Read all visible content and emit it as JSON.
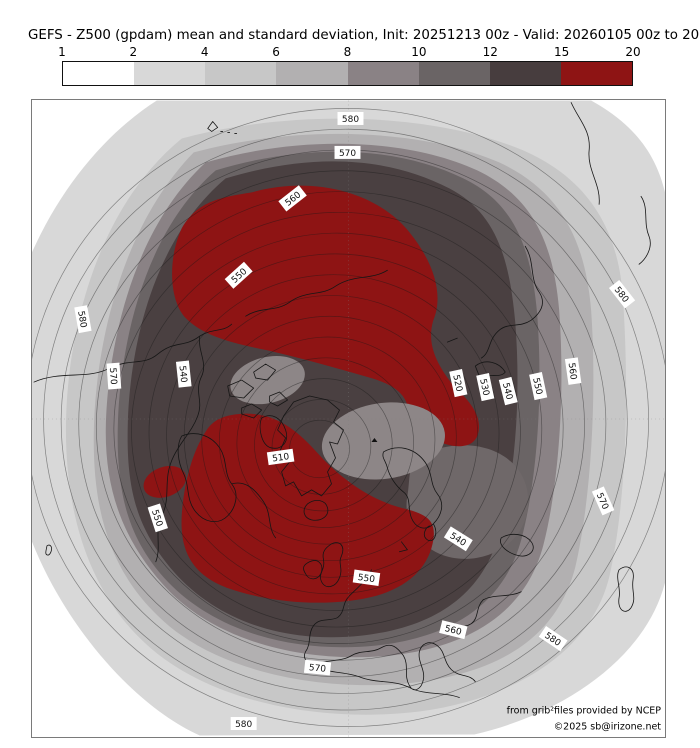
{
  "title": "GEFS - Z500 (gpdam) mean and standard deviation, Init: 20251213 00z - Valid: 20260105 00z to 20260112 00z",
  "colorbar": {
    "ticks": [
      "1",
      "2",
      "4",
      "6",
      "8",
      "10",
      "12",
      "15",
      "20"
    ],
    "segments": [
      {
        "range": "1-2",
        "color": "#ffffff"
      },
      {
        "range": "2-4",
        "color": "#d8d8d8"
      },
      {
        "range": "4-6",
        "color": "#c7c7c7"
      },
      {
        "range": "6-8",
        "color": "#b2b0b1"
      },
      {
        "range": "8-10",
        "color": "#8a8285"
      },
      {
        "range": "10-12",
        "color": "#6a6465"
      },
      {
        "range": "12-15",
        "color": "#473d3e"
      },
      {
        "range": "15-20",
        "color": "#8e1414"
      }
    ]
  },
  "palette": {
    "sd_1_2": "#ffffff",
    "sd_2_4": "#d8d8d8",
    "sd_4_6": "#c7c7c7",
    "sd_6_8": "#b2b0b1",
    "sd_8_10": "#8a8285",
    "sd_10_12": "#6a6465",
    "sd_12_15": "#473d3e",
    "sd_15_20": "#8e1414",
    "map_core": "#4a4041",
    "map_patch": "#8d8687",
    "map_se_patch": "#6f6869"
  },
  "map": {
    "attribution_line1": "from grib²files provided by NCEP",
    "attribution_line2": "©2025 sb@irizone.net",
    "contour_labels": [
      {
        "v": "580",
        "x": 319,
        "y": 18,
        "r": 0
      },
      {
        "v": "570",
        "x": 316,
        "y": 52,
        "r": 0
      },
      {
        "v": "560",
        "x": 261,
        "y": 98,
        "r": -38
      },
      {
        "v": "550",
        "x": 207,
        "y": 175,
        "r": -42
      },
      {
        "v": "580",
        "x": 51,
        "y": 219,
        "r": 80
      },
      {
        "v": "570",
        "x": 82,
        "y": 276,
        "r": 86
      },
      {
        "v": "540",
        "x": 152,
        "y": 274,
        "r": 84
      },
      {
        "v": "550",
        "x": 126,
        "y": 418,
        "r": 72
      },
      {
        "v": "510",
        "x": 249,
        "y": 357,
        "r": -8
      },
      {
        "v": "520",
        "x": 427,
        "y": 283,
        "r": 78
      },
      {
        "v": "530",
        "x": 454,
        "y": 287,
        "r": 78
      },
      {
        "v": "540",
        "x": 477,
        "y": 291,
        "r": 76
      },
      {
        "v": "550",
        "x": 507,
        "y": 286,
        "r": 78
      },
      {
        "v": "560",
        "x": 542,
        "y": 271,
        "r": 82
      },
      {
        "v": "580",
        "x": 591,
        "y": 194,
        "r": 52
      },
      {
        "v": "570",
        "x": 572,
        "y": 401,
        "r": 66
      },
      {
        "v": "540",
        "x": 427,
        "y": 439,
        "r": 32
      },
      {
        "v": "550",
        "x": 335,
        "y": 478,
        "r": 8
      },
      {
        "v": "560",
        "x": 422,
        "y": 530,
        "r": 14
      },
      {
        "v": "580",
        "x": 522,
        "y": 539,
        "r": 34
      },
      {
        "v": "570",
        "x": 286,
        "y": 568,
        "r": 6
      },
      {
        "v": "580",
        "x": 212,
        "y": 624,
        "r": 0
      }
    ]
  },
  "chart_data": {
    "type": "contour-map",
    "projection": "Northern Hemisphere polar stereographic (Europe at bottom, North America left, Asia right)",
    "field": "GEFS ensemble mean Z500 height contours (gpdam) over ensemble standard deviation shading",
    "init": "20251213 00z",
    "valid": "20260105 00z to 20260112 00z",
    "contour_interval_gpdam": 5,
    "labeled_contours_gpdam": [
      510,
      520,
      530,
      540,
      550,
      560,
      570,
      580
    ],
    "mean_min_gpdam": 510,
    "mean_max_gpdam": 580,
    "shading_class_bounds": [
      1,
      2,
      4,
      6,
      8,
      10,
      12,
      15,
      20
    ],
    "shading_class_colors": [
      "#ffffff",
      "#d8d8d8",
      "#c7c7c7",
      "#b2b0b1",
      "#8a8285",
      "#6a6465",
      "#473d3e",
      "#8e1414"
    ],
    "legend_position": "top, horizontal colorbar",
    "notable_features": [
      "Z500 minimum (~510 gpdam) near the pole / Greenland side of the Arctic",
      "Heights increase outward to ~580-585 gpdam at the subtropical map edges",
      "Very high spread (15-20) blob over the Arctic / eastern Siberia sector",
      "Very high spread (15-20) region from Greenland-Iceland across the UK and Scandinavia",
      "Small high-spread spot over the eastern North Pacific",
      "Lower-spread (8-10) pockets embedded in the dark high-spread polar region",
      "Spread below 2 (white) at the four subtropical corners of the map"
    ],
    "source_note": "from grib²files provided by NCEP",
    "copyright": "©2025 sb@irizone.net"
  }
}
